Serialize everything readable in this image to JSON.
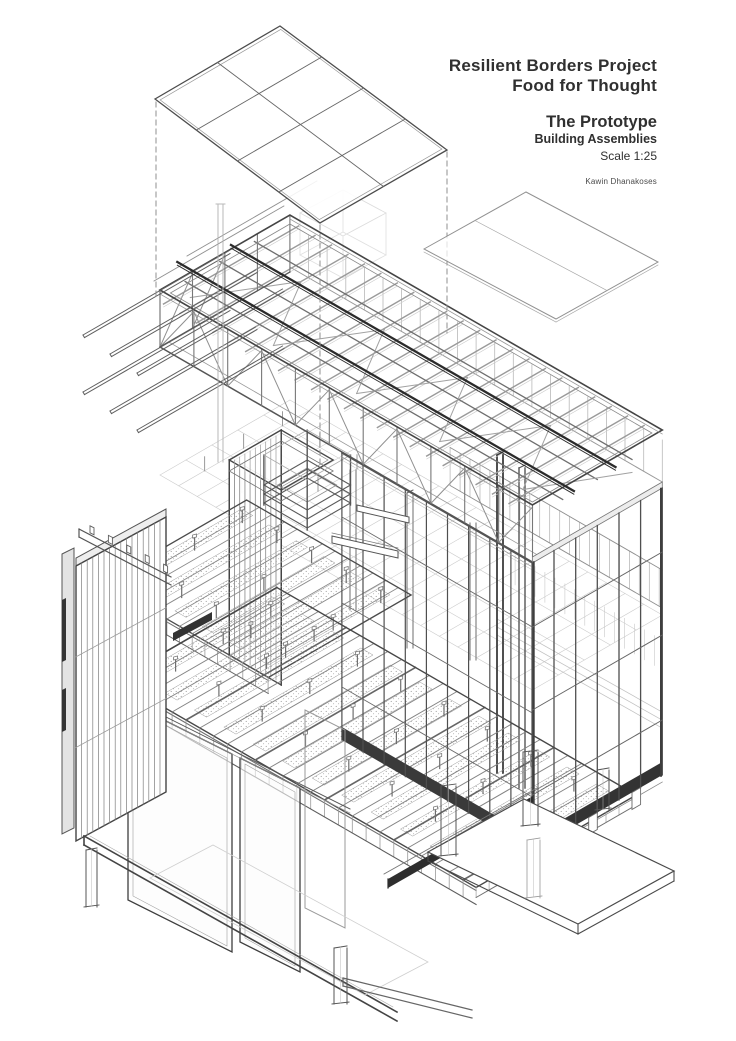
{
  "title_block": {
    "project_line1": "Resilient Borders Project",
    "project_line2": "Food for Thought",
    "drawing_title": "The Prototype",
    "drawing_subtitle": "Building Assemblies",
    "scale_label": "Scale 1:25",
    "author": "Kawin Dhanakoses"
  },
  "drawing": {
    "description": "Exploded axonometric line drawing of a building prototype showing a floating roof sheathing panel, roof truss assembly with cantilevered purlins, glazed curtain walls, floor decks with insulated panels, slatted wall assembly, sliding panels, edge channel beams, foundation pedestals and ground slab.",
    "view": "exploded axonometric",
    "line_color": "#4a4a4a",
    "light_line_color": "#c0c0c0",
    "dark_fill_color": "#2e2e2e",
    "background_color": "#ffffff",
    "components": [
      "roof-sheathing-panel",
      "roof-sheathing-panel-offset",
      "roof-truss-assembly",
      "cantilevered-purlins",
      "steel-ridge-beams",
      "glazed-curtain-wall-front",
      "glazed-curtain-wall-end",
      "clerestory-band",
      "ceiling-grid",
      "service-shaft",
      "skylight-curb",
      "upper-floor-panels",
      "ground-floor-deck",
      "sliding-wall-panels",
      "slatted-wall-assembly",
      "edge-channel-beams",
      "foundation-pedestals",
      "ground-slab"
    ]
  }
}
